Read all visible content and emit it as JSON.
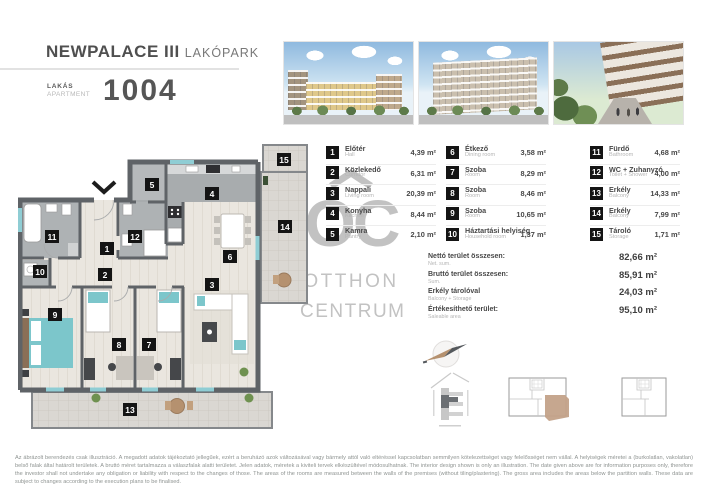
{
  "header": {
    "project": "NEWPALACE III",
    "project_suffix": "LAKÓPARK",
    "apartment_label_hu": "LAKÁS",
    "apartment_label_en": "APARTMENT",
    "apartment_number": "1004"
  },
  "watermark": {
    "letters": "OC",
    "line1": "OTTHON",
    "line2": "CENTRUM"
  },
  "rooms": [
    {
      "id": "1",
      "name_hu": "Előtér",
      "name_en": "Hall",
      "area": "4,39 m²"
    },
    {
      "id": "2",
      "name_hu": "Közlekedő",
      "name_en": "Corridor",
      "area": "6,31 m²"
    },
    {
      "id": "3",
      "name_hu": "Nappali",
      "name_en": "Living room",
      "area": "20,39 m²"
    },
    {
      "id": "4",
      "name_hu": "Konyha",
      "name_en": "Kitchen",
      "area": "8,44 m²"
    },
    {
      "id": "5",
      "name_hu": "Kamra",
      "name_en": "Pantry",
      "area": "2,10 m²"
    },
    {
      "id": "6",
      "name_hu": "Étkező",
      "name_en": "Dining room",
      "area": "3,58 m²"
    },
    {
      "id": "7",
      "name_hu": "Szoba",
      "name_en": "Room",
      "area": "8,29 m²"
    },
    {
      "id": "8",
      "name_hu": "Szoba",
      "name_en": "Room",
      "area": "8,46 m²"
    },
    {
      "id": "9",
      "name_hu": "Szoba",
      "name_en": "Room",
      "area": "10,65 m²"
    },
    {
      "id": "10",
      "name_hu": "Háztartási helyiség",
      "name_en": "Household room",
      "area": "1,37 m²"
    },
    {
      "id": "11",
      "name_hu": "Fürdő",
      "name_en": "Bathroom",
      "area": "4,68 m²"
    },
    {
      "id": "12",
      "name_hu": "WC + Zuhanyzó",
      "name_en": "Toilet + Shower",
      "area": "4,00 m²"
    },
    {
      "id": "13",
      "name_hu": "Erkély",
      "name_en": "Balcony",
      "area": "14,33 m²"
    },
    {
      "id": "14",
      "name_hu": "Erkély",
      "name_en": "Balcony",
      "area": "7,99 m²"
    },
    {
      "id": "15",
      "name_hu": "Tároló",
      "name_en": "Storage",
      "area": "1,71 m²"
    }
  ],
  "summary": [
    {
      "label_hu": "Nettó terület összesen:",
      "label_en": "Net. sum.",
      "value": "82,66 m²"
    },
    {
      "label_hu": "Bruttó terület összesen:",
      "label_en": "Sum.",
      "value": "85,91 m²"
    },
    {
      "label_hu": "Erkély tárolóval",
      "label_en": "Balcony + Storage",
      "value": "24,03 m²"
    },
    {
      "label_hu": "Értékesíthető terület:",
      "label_en": "Saleable area",
      "value": "95,10 m²"
    }
  ],
  "disclaimer": {
    "hu": "Az ábrázolt berendezés csak illusztráció. A megadott adatok tájékoztató jellegűek, ezért a beruházó azok változásával vagy bármely attól való eltéréssel kapcsolatban semmilyen kötelezettséget vagy felelősséget nem vállal. A helyiségek méretei a (burkolatlan, vakolatlan) belső falak által határolt területek. A bruttó méret tartalmazza a válaszfalak alatti területet. Jelen adatok, méretek a kiviteli tervek elkészültével módosulhatnak.",
    "en": "The interior design shown is only an illustration. The date given above are for information purposes only, therefore the investor shall not undertake any obligation or liability with respect to the changes of those. The areas of the rooms are measured between the walls of the premises (without tiling/plastering). The gross area includes the areas below the partition walls. These data are subject to changes according to the execution plans to be finalised."
  },
  "colors": {
    "wall": "#5f6367",
    "wet_room_floor": "#aeb2b4",
    "wood_floor": "#eae6df",
    "balcony_floor": "#dad7d2",
    "window_teal": "#8fcdd4",
    "accent_teal": "#7cc6cb",
    "accent_tan": "#b5916f",
    "badge_black": "#141414",
    "watermark_gray": "#c2c2c2"
  }
}
